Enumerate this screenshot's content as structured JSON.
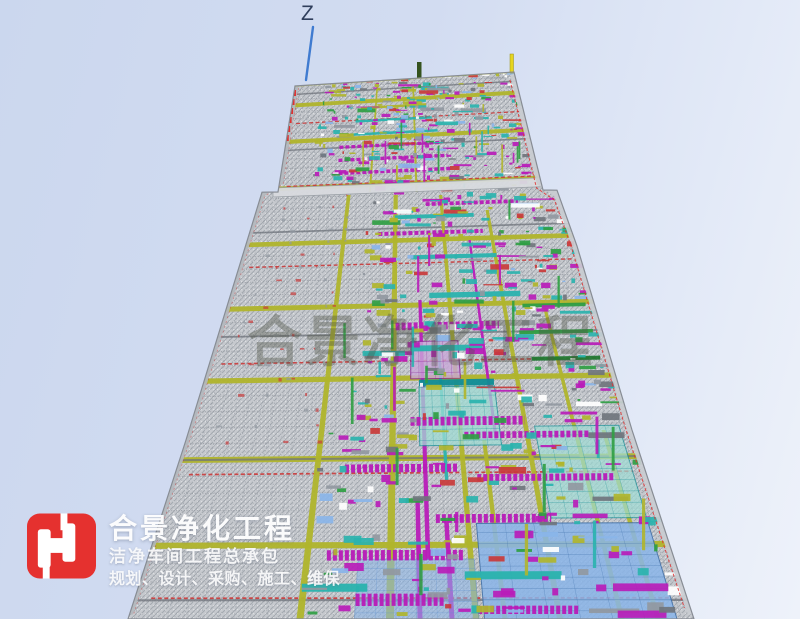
{
  "axis": {
    "z_label": "Z",
    "line_color": "#3f7bd0"
  },
  "watermark": {
    "text": "合景净化工程",
    "color": "#4f5345",
    "opacity": 0.38
  },
  "logo": {
    "title": "合景净化工程",
    "subtitle": "洁净车间工程总承包",
    "tagline": "规划、设计、采购、施工、维保",
    "mark_color": "#e5312f",
    "mark_glyph_color": "#ffffff",
    "text_color": "#ffffff"
  },
  "model": {
    "label": "cleanroom-mep-bim-perspective-view",
    "palette": {
      "base": "#c6c9ce",
      "hatch": "#a4a9b0",
      "panelLine": "#8f949c",
      "olive": "#b0b52c",
      "oliveBright": "#c9cf30",
      "oliveDark": "#8f9422",
      "red": "#c93a3a",
      "redBright": "#e03030",
      "magenta": "#b81cb8",
      "magentaDark": "#871b94",
      "purpleLight": "#c9a8d8",
      "teal": "#2ab3ae",
      "tealDark": "#0f8d95",
      "tealLight": "#9fdcd4",
      "green": "#2f9e43",
      "greenDark": "#217a32",
      "blue": "#8ab5e9",
      "blueMid": "#5b90d0",
      "blueDark": "#3c6ea8",
      "gray": "#9198a1",
      "grayDark": "#70757d",
      "bandLeft": "#b4b8be",
      "bandRight": "#c9ccd1",
      "divider": "#d8dbdf",
      "outline": "#878c94",
      "yellowPost": "#e6d51f",
      "figure": "#35531f",
      "white": "#ffffff"
    },
    "geometry": {
      "left_edge": [
        [
          86,
          295
        ],
        [
          192,
          278
        ],
        [
          192.2,
          262
        ],
        [
          440,
          186
        ],
        [
          619,
          128
        ]
      ],
      "right_edge": [
        [
          72,
          514
        ],
        [
          190,
          543
        ],
        [
          190.2,
          557
        ],
        [
          246,
          577
        ],
        [
          430,
          632
        ],
        [
          619,
          694
        ]
      ],
      "top_y": 79,
      "bottom_y": 619,
      "vp": [
        402,
        -268
      ],
      "rows": 46,
      "row_pow": 1.6,
      "divider_y": 192,
      "seed": 20240513
    },
    "features": {
      "v_runs": [
        [
          300,
          195,
          619,
          7,
          "olive"
        ],
        [
          390,
          195,
          619,
          8,
          "olive"
        ],
        [
          476,
          195,
          619,
          6,
          "olive"
        ],
        [
          340,
          86,
          192,
          4,
          "olive"
        ],
        [
          430,
          86,
          192,
          4,
          "olive"
        ],
        [
          560,
          210,
          619,
          6,
          "olive"
        ],
        [
          622,
          300,
          619,
          5,
          "olive"
        ],
        [
          658,
          430,
          619,
          5,
          "olive"
        ],
        [
          505,
          440,
          619,
          5,
          "olive"
        ],
        [
          430,
          300,
          560,
          5,
          "magenta"
        ],
        [
          455,
          340,
          480,
          4,
          "teal"
        ],
        [
          520,
          240,
          440,
          4,
          "magenta"
        ],
        [
          420,
          500,
          619,
          5,
          "magenta"
        ],
        [
          452,
          520,
          619,
          5,
          "magenta"
        ]
      ],
      "h_runs": [
        [
          112,
          0.3,
          0.58,
          4,
          "olive"
        ],
        [
          125,
          0.28,
          0.6,
          4,
          "teal"
        ],
        [
          138,
          0.25,
          0.62,
          4,
          "teal"
        ],
        [
          150,
          0.22,
          0.63,
          5,
          "magenta"
        ],
        [
          163,
          0.22,
          0.65,
          5,
          "magenta"
        ],
        [
          176,
          0.2,
          0.66,
          5,
          "magenta"
        ],
        [
          210,
          0.55,
          0.85,
          5,
          "magenta"
        ],
        [
          222,
          0.45,
          0.7,
          5,
          "teal"
        ],
        [
          238,
          0.4,
          0.72,
          5,
          "magenta"
        ],
        [
          262,
          0.5,
          0.75,
          5,
          "teal"
        ],
        [
          300,
          0.55,
          0.8,
          6,
          "teal"
        ],
        [
          312,
          0.8,
          0.97,
          4,
          "green"
        ],
        [
          330,
          0.46,
          0.73,
          8,
          "magenta"
        ],
        [
          338,
          0.78,
          0.97,
          4,
          "green"
        ],
        [
          352,
          0.5,
          0.68,
          6,
          "teal"
        ],
        [
          364,
          0.8,
          0.97,
          4,
          "greenDark"
        ],
        [
          386,
          0.52,
          0.7,
          6,
          "tealDark"
        ],
        [
          424,
          0.5,
          0.76,
          8,
          "magenta"
        ],
        [
          438,
          0.62,
          0.9,
          6,
          "magenta"
        ],
        [
          470,
          0.36,
          0.6,
          7,
          "magenta"
        ],
        [
          480,
          0.64,
          0.93,
          6,
          "magenta"
        ],
        [
          520,
          0.55,
          0.78,
          7,
          "magenta"
        ],
        [
          556,
          0.34,
          0.6,
          8,
          "magenta"
        ],
        [
          576,
          0.6,
          0.78,
          6,
          "teal"
        ],
        [
          588,
          0.3,
          0.42,
          6,
          "teal"
        ],
        [
          600,
          0.4,
          0.56,
          9,
          "magenta"
        ],
        [
          610,
          0.62,
          0.8,
          6,
          "magenta"
        ]
      ],
      "panels": [
        [
          345,
          382,
          0.5,
          0.62,
          "purpleLight",
          "magentaDark",
          0.8
        ],
        [
          390,
          448,
          0.52,
          0.7,
          "tealLight",
          "tealDark",
          0.75
        ],
        [
          430,
          520,
          0.78,
          0.97,
          "tealLight",
          "tealDark",
          0.7
        ],
        [
          525,
          619,
          0.63,
          0.97,
          "blue",
          "blueDark",
          0.85
        ],
        [
          560,
          619,
          0.4,
          0.62,
          "blue",
          "blueMid",
          0.55
        ]
      ]
    }
  }
}
